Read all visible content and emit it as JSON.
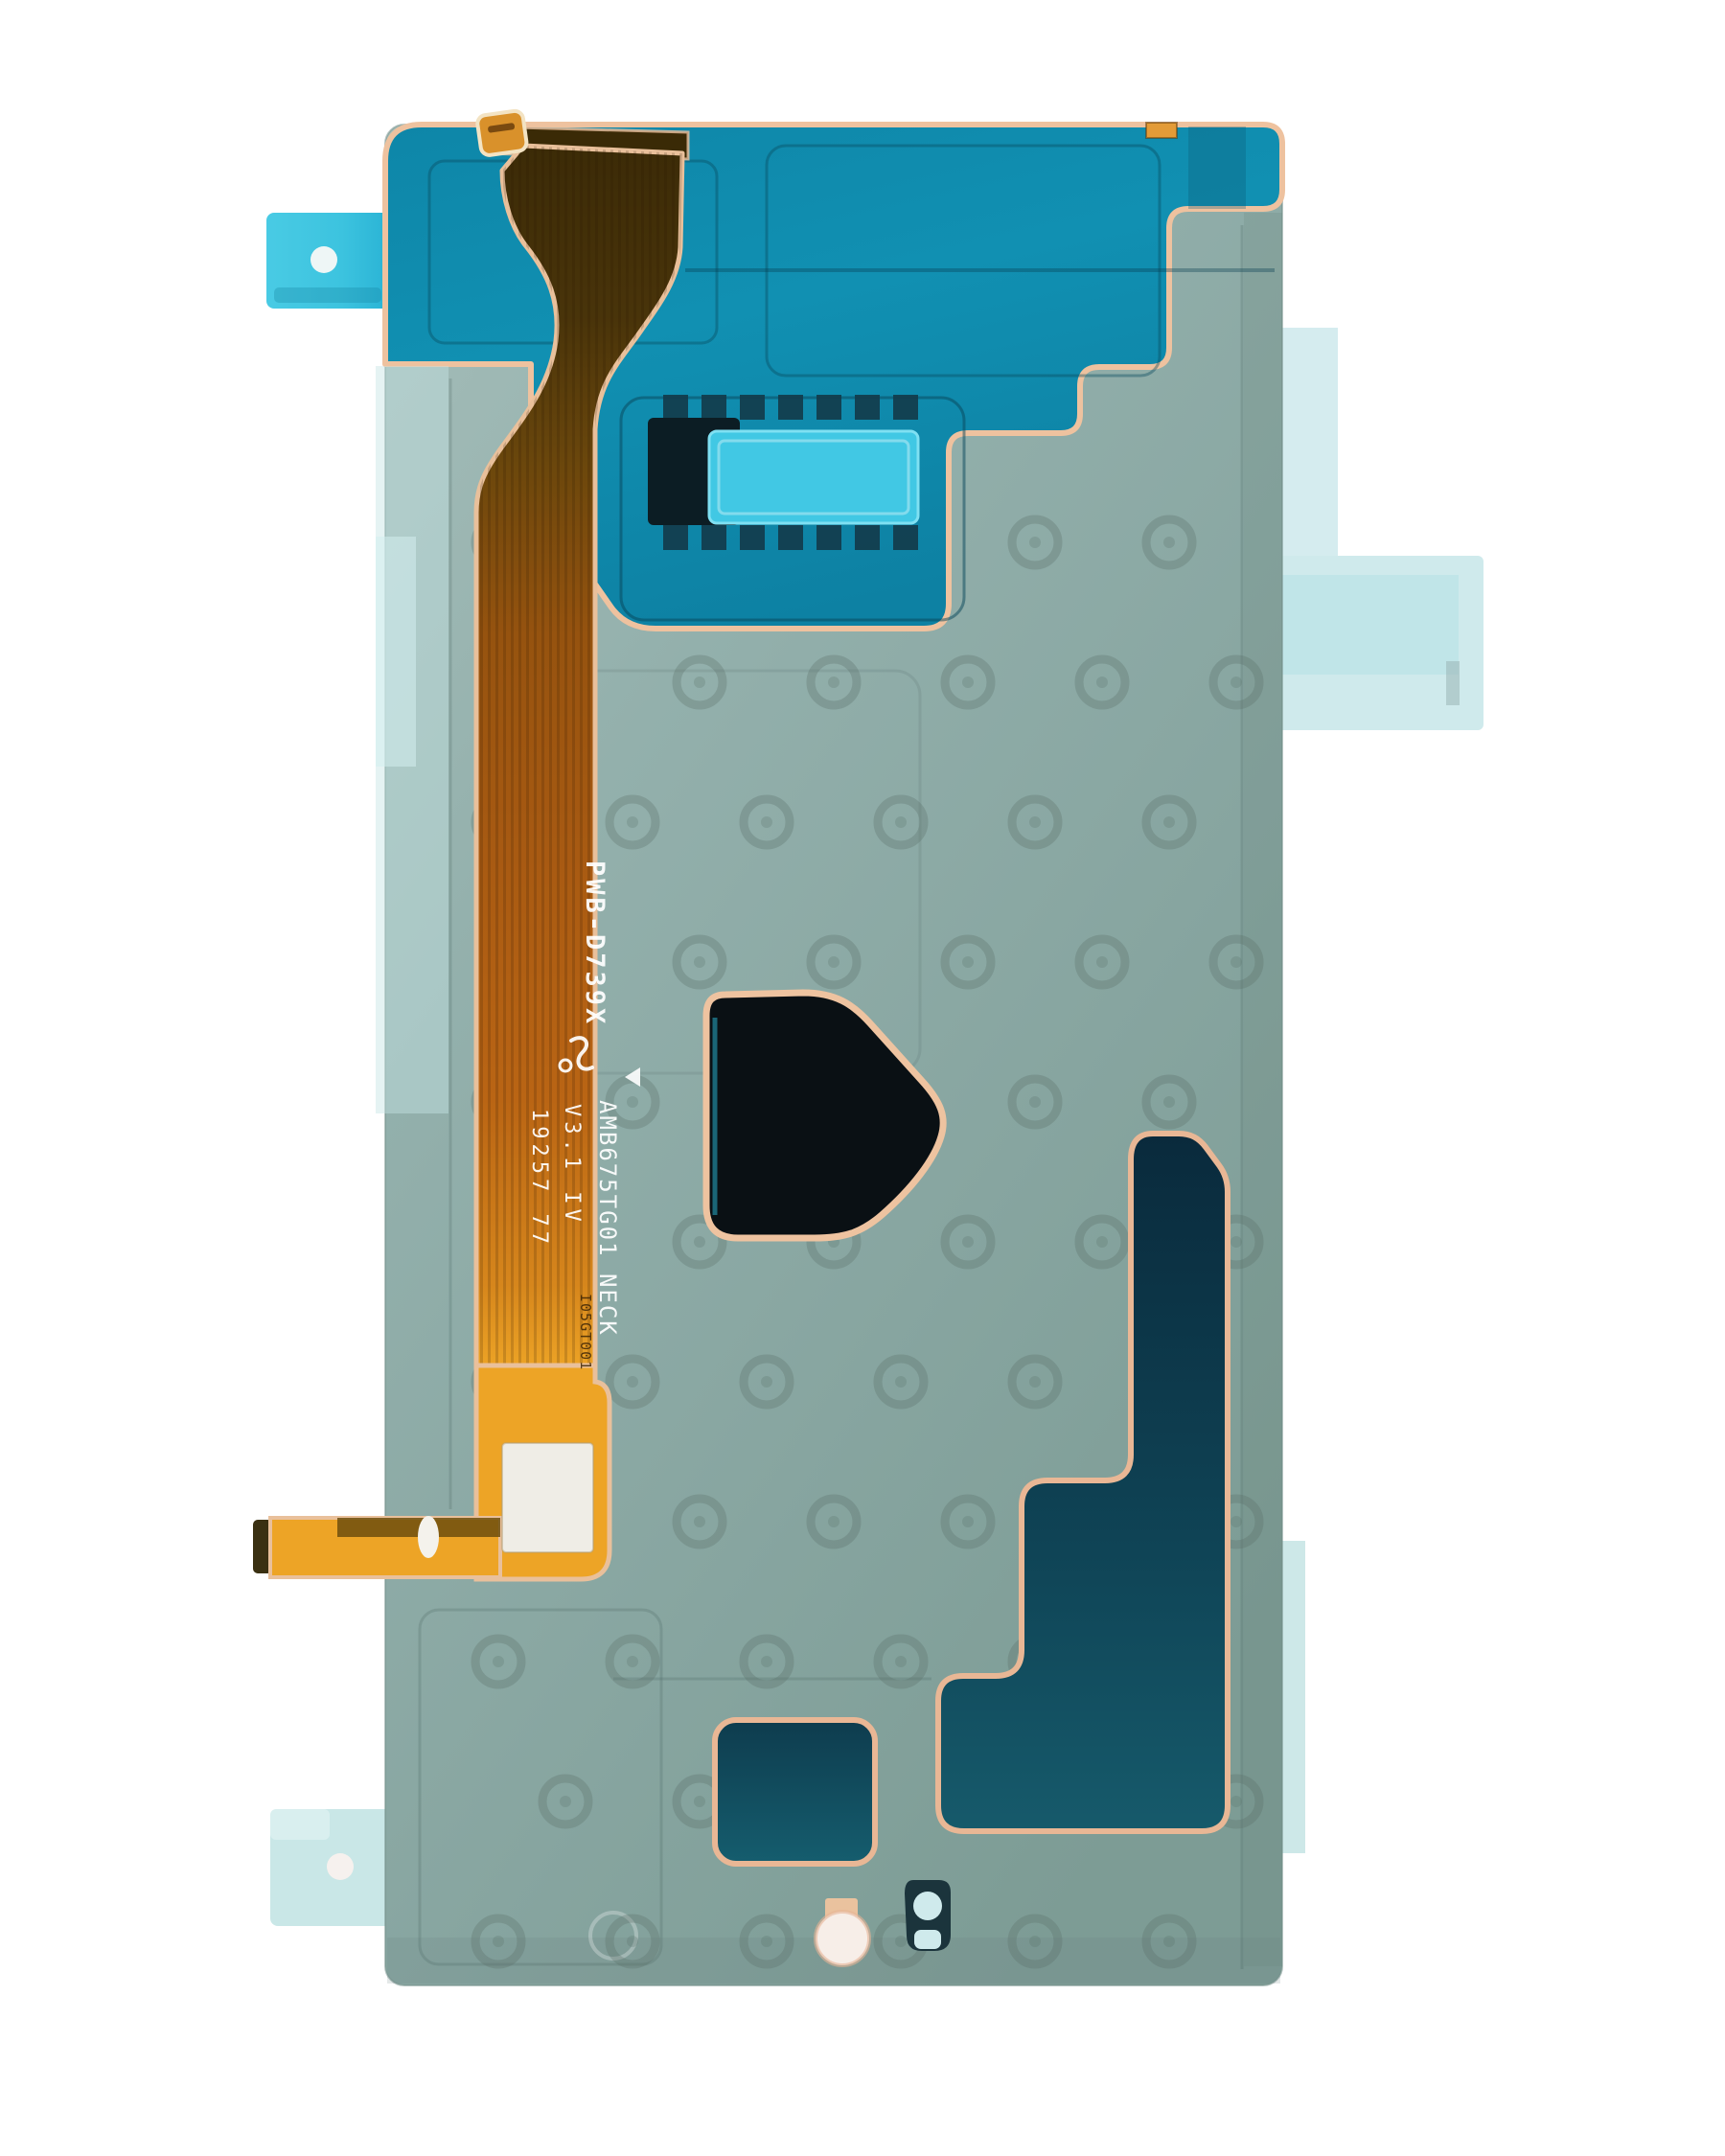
{
  "markings": {
    "line1": "PWB-D739X",
    "line2": "AMB675TG01  NECK",
    "line3": "V3.1   IV",
    "line4": "19257   77",
    "stamp": "I05GT001"
  },
  "colors": {
    "background": "#ffffff",
    "teal_layer": "#0f8aab",
    "body_film": "#8fada9",
    "flex_dark_brown": "#3c2b07",
    "flex_orange": "#a85a12",
    "flex_yellow": "#eda426",
    "peach_outline": "#ecc09e",
    "bright_cyan_sticker": "#41c8e4",
    "cyan_tab": "#3cc3df",
    "pale_tab": "#c9e7e7",
    "dark_cutout": "#0a1014",
    "dark_navy_region": "#0a2a3c"
  },
  "parts": {
    "main_film": "digitizer-adhesive-film",
    "teal_region": "upper-adhesive-layer",
    "flex_cable": "flex-ribbon-cable",
    "connector": "board-connector",
    "sticker": "cyan-pull-sticker",
    "label": "white-label",
    "left_tab": "pull-tab-left",
    "right_tab": "pull-tab-right",
    "bottom_tab": "pull-tab-bottom-left",
    "cutout_center": "pen-cutout",
    "cutout_stair": "battery-cutout",
    "cutout_square": "vibrator-cutout",
    "keyhole": "camera-keyhole-mark",
    "white_dot": "alignment-dot"
  }
}
